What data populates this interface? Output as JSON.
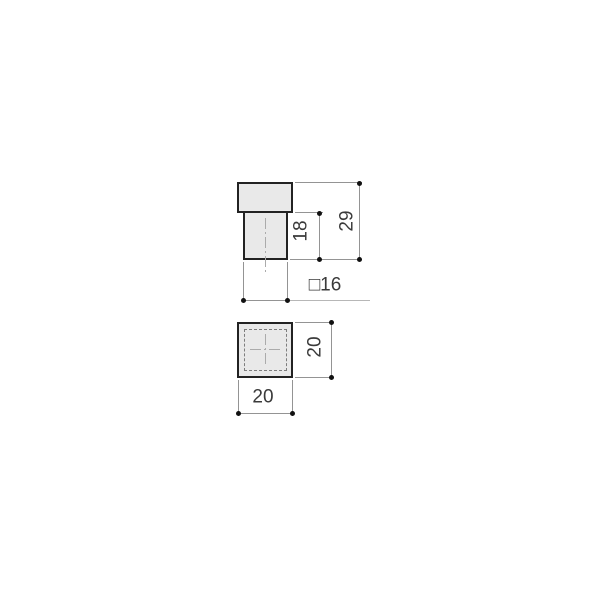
{
  "drawing": {
    "type": "technical-dimension-drawing",
    "subject": "square knob, front elevation and top view",
    "colors": {
      "background": "#ffffff",
      "part_fill": "#e9e9e9",
      "part_outline": "#222222",
      "dimension_lines": "#949494",
      "leader_line": "#b7b7b7",
      "hidden_edge": "#7d7d7d",
      "centerline": "#ababab",
      "endpoint_dots": "#111111",
      "text": "#3a3a3a"
    },
    "front_view": {
      "dim_shank_height_label": "18",
      "dim_overall_height_label": "29",
      "dim_square_section_label": "□16"
    },
    "top_view": {
      "dim_height_label": "20",
      "dim_width_label": "20"
    }
  }
}
